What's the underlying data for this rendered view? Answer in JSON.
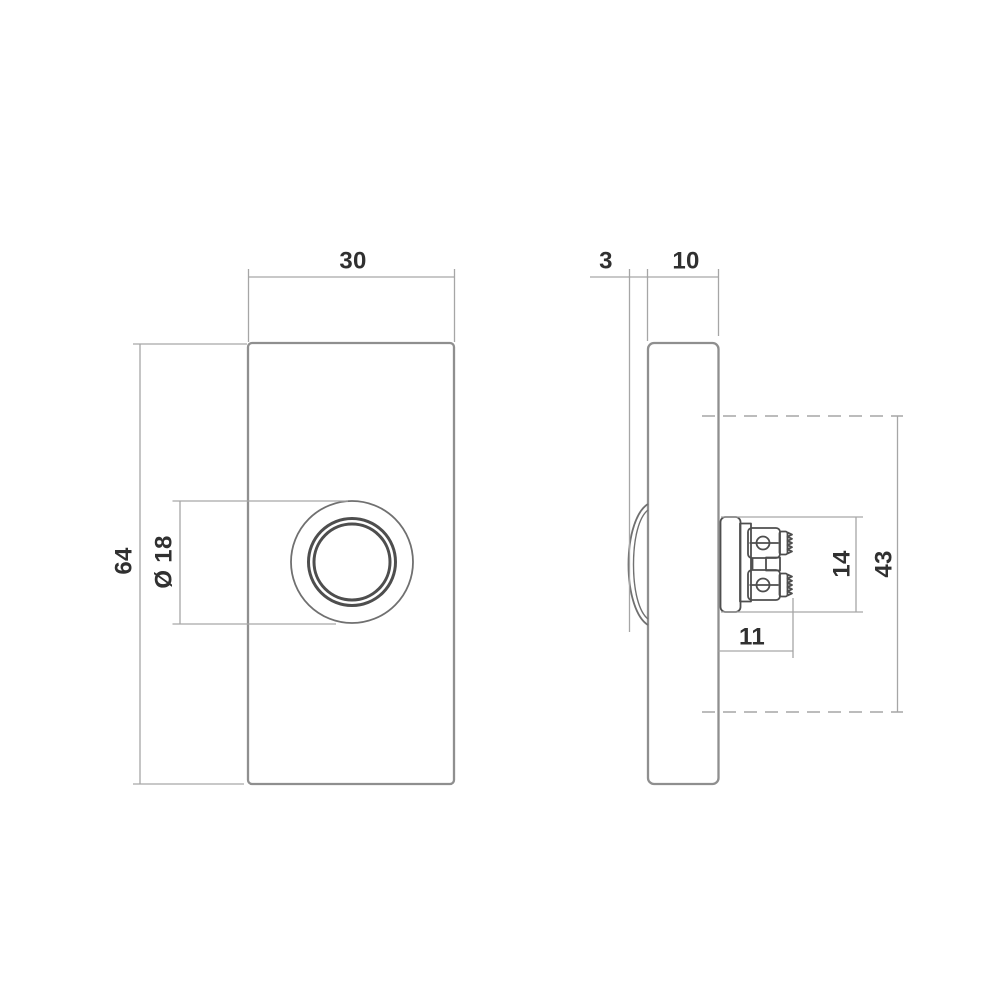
{
  "page": {
    "background": "#ffffff",
    "description": "Technical dimension drawing of a rectangular push-button (front view and side view)"
  },
  "colors": {
    "outline": "#8f8f8f",
    "button": "#707070",
    "detail": "#4e4e4e",
    "dimension": "#a6a6a6",
    "text": "#303030"
  },
  "front_view": {
    "width_mm": "30",
    "height_mm": "64",
    "button_diameter_mm": "Ø 18"
  },
  "side_view": {
    "button_protrusion_mm": "3",
    "housing_depth_mm": "10",
    "terminal_block_diameter_mm": "14",
    "centerline_distance_mm": "43",
    "terminal_depth_mm": "11"
  }
}
